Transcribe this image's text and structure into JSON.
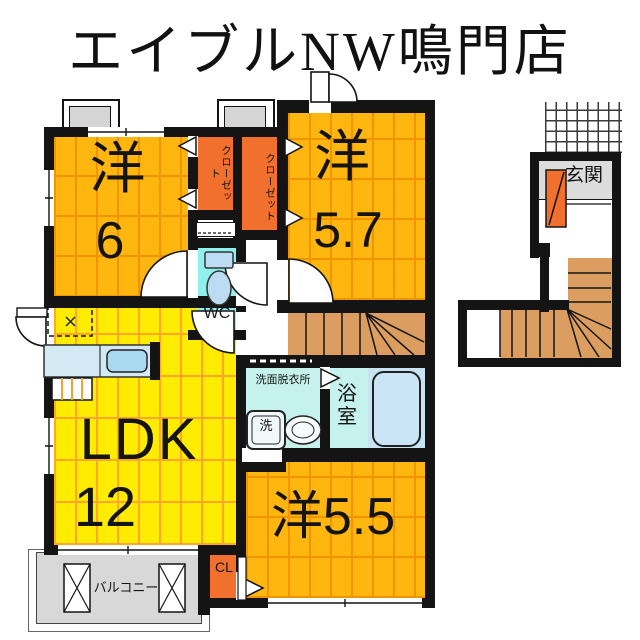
{
  "title": "エイブルNW鳴門店",
  "plan2f": {
    "room_yo6": {
      "kanji": "洋",
      "size": "6"
    },
    "room_yo57": {
      "kanji": "洋",
      "size": "5.7"
    },
    "room_ldk": {
      "name": "LDK",
      "size": "12"
    },
    "room_yo55": {
      "label": "洋5.5"
    },
    "closet1": "クローゼット",
    "closet2": "クローゼット",
    "wc": "WC",
    "washroom": "洗面脱衣所",
    "washer": "洗",
    "bath": "浴室",
    "balcony": "バルコニー",
    "closet_cl": "CL"
  },
  "plan1f": {
    "entrance": "玄関"
  },
  "colors": {
    "wall": "#141414",
    "room_orange": "#FFB60F",
    "plank_line_orange": "#F29400",
    "room_yellow": "#FFEC00",
    "plank_line_yellow": "#FFA62B",
    "closet_orange": "#F2702D",
    "wc_cyan": "#8FF0EE",
    "wetroom_cyan": "#C6F2EE",
    "stair_tan": "#DB9D60",
    "balcony_gray": "#D8D8D8",
    "entrance_gray": "#DCDCDC",
    "fixture_blue": "#BCDCF4"
  }
}
